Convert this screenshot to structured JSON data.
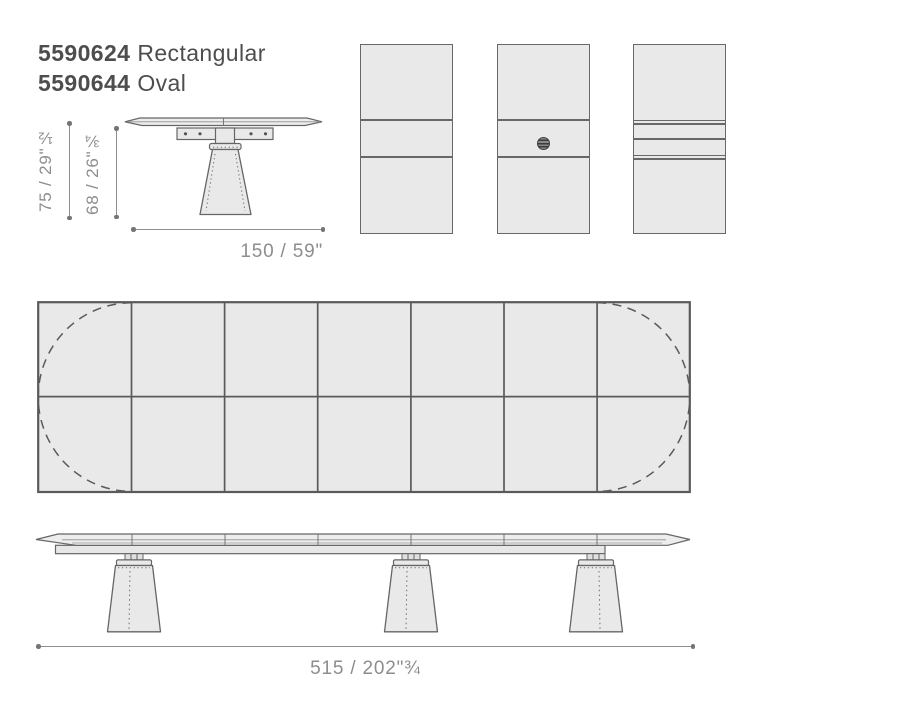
{
  "title_block": {
    "products": [
      {
        "code": "5590624",
        "type": "Rectangular"
      },
      {
        "code": "5590644",
        "type": "Oval"
      }
    ]
  },
  "dimensions": {
    "height_total": "75 / 29\"½",
    "height_underside": "68 / 26\"¾",
    "side_width": "150 / 59\"",
    "total_length": "515  / 202\"¾"
  },
  "views": {
    "side_view": "table side elevation with pedestal leg",
    "top_panels": [
      "plain top with two seams",
      "top with cable grommet",
      "top with extension leaves"
    ],
    "plan_view": "7x2 sectioned rectangular top with dashed oval outline",
    "front_elevation": "long table with three tapered legs"
  },
  "colors": {
    "background": "#ffffff",
    "surface_fill": "#e9e9e9",
    "outline": "#666666",
    "dimension": "#8d8d8d",
    "title_text": "#4d4d4d"
  }
}
